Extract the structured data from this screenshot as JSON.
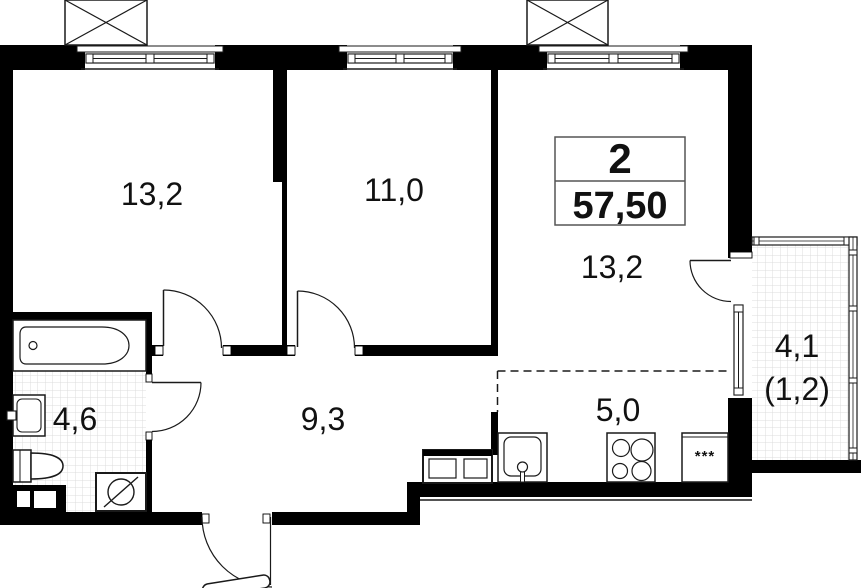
{
  "plan": {
    "unit_info": {
      "room_count": "2",
      "total_area": "57,50"
    },
    "rooms": {
      "bedroom1": {
        "area": "13,2"
      },
      "bedroom2": {
        "area": "11,0"
      },
      "living": {
        "area": "13,2"
      },
      "bathroom": {
        "area": "4,6"
      },
      "hallway": {
        "area": "9,3"
      },
      "kitchen": {
        "area": "5,0"
      },
      "balcony": {
        "area": "4,1",
        "area_weighted": "(1,2)"
      }
    },
    "symbols": {
      "fridge_marker": "***"
    }
  },
  "colors": {
    "wall": "#000000",
    "tile_line": "#dcdcdc",
    "background": "#ffffff"
  }
}
